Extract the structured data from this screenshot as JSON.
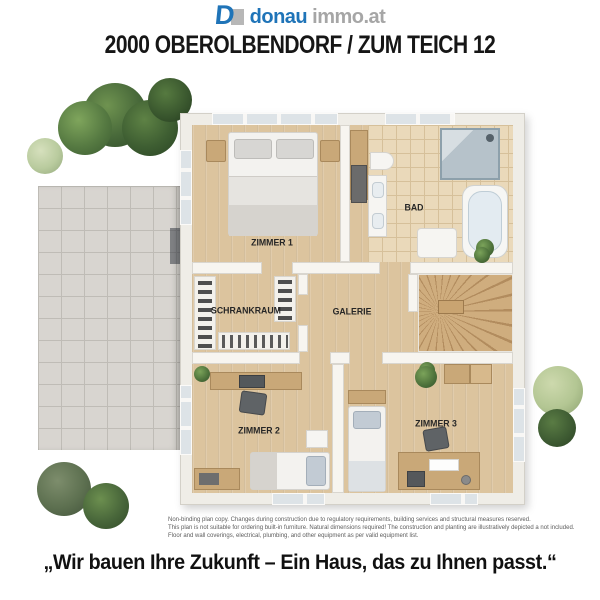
{
  "header": {
    "logo": {
      "mark": "D",
      "brand_blue": "donau",
      "brand_gray": "immo.at"
    },
    "title": "2000 OBEROLBENDORF / ZUM TEICH 12"
  },
  "plan": {
    "rooms": [
      {
        "label": "ZIMMER 1"
      },
      {
        "label": "BAD"
      },
      {
        "label": "SCHRANKRAUM"
      },
      {
        "label": "GALERIE"
      },
      {
        "label": "ZIMMER 2"
      },
      {
        "label": "ZIMMER 3"
      }
    ]
  },
  "footer": {
    "disclaimer_lines": [
      "Non-binding plan copy. Changes during construction due to regulatory requirements, building services and structural measures reserved.",
      "This plan is not suitable for ordering built-in furniture. Natural dimensions required! The construction and planting are illustratively depicted a not included.",
      "Floor and wall coverings, electrical, plumbing, and other equipment as per valid equipment list."
    ],
    "slogan": "„Wir bauen Ihre Zukunft – Ein Haus, das zu Ihnen passt.“"
  },
  "colors": {
    "brand_blue": "#1f74b8",
    "brand_gray": "#a6a6a6",
    "wood_floor": "#dcc49e",
    "bath_tile": "#ead9ba",
    "terrace_tile": "#d8d5d0",
    "wall": "#f7f5f0",
    "tree_dark": "#3f5c33",
    "tree_light": "#b3c693"
  }
}
